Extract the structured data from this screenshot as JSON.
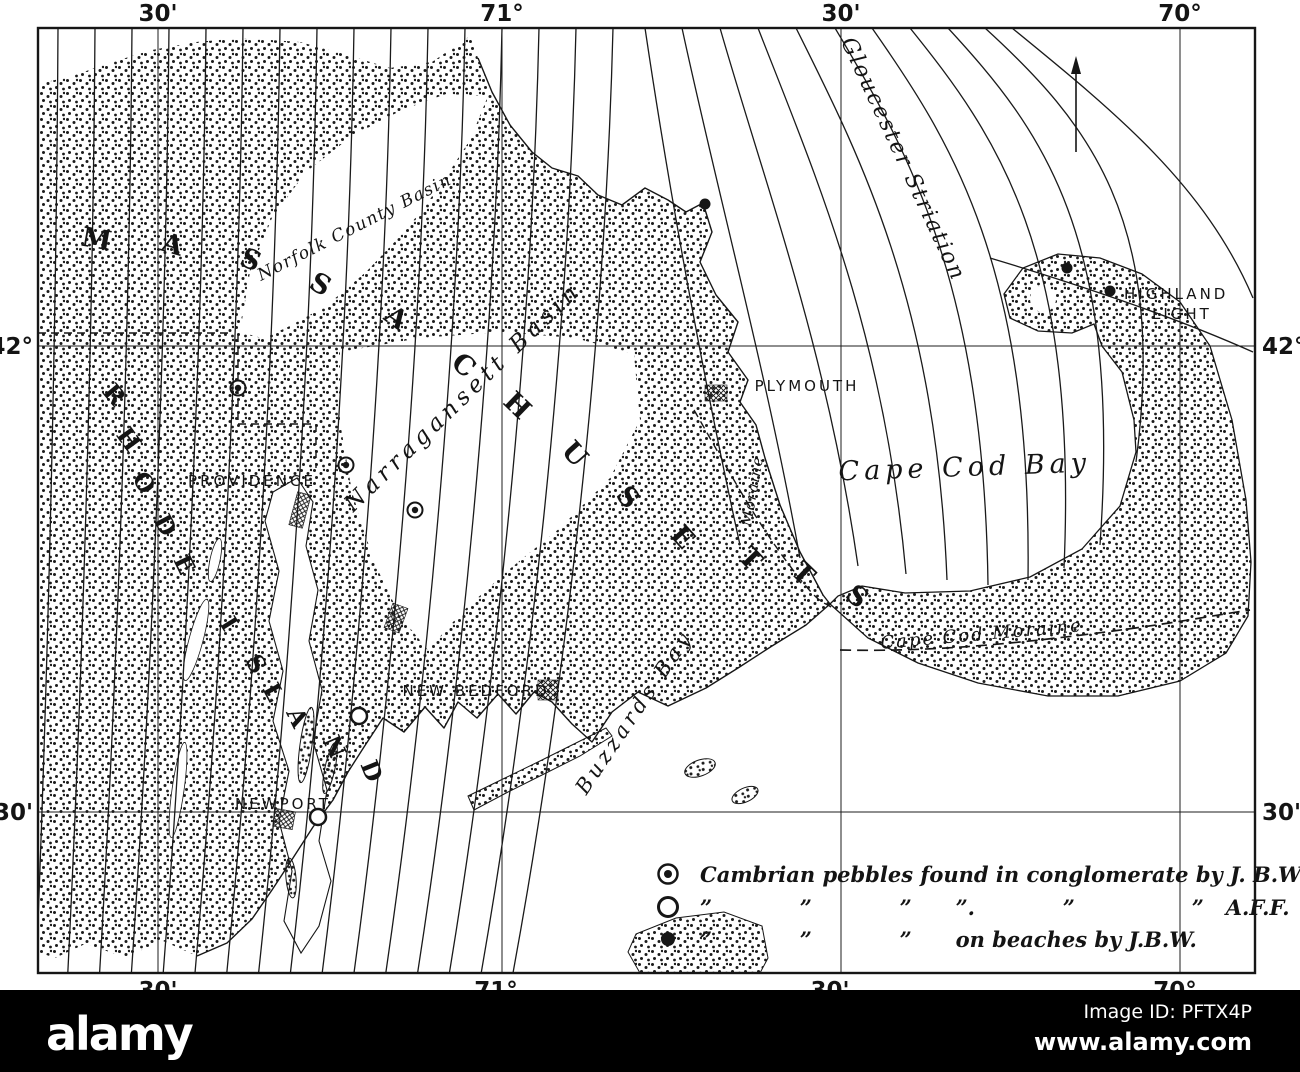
{
  "map": {
    "grid": {
      "top": [
        "30'",
        "71°",
        "30'",
        "70°"
      ],
      "bottom": [
        "30'",
        "71°",
        "30'",
        "70°"
      ],
      "left": [
        "42°",
        "30'"
      ],
      "right": [
        "42°",
        "30'"
      ]
    },
    "states": {
      "massachusetts": {
        "name": "MASSACHUSETTS",
        "letters": [
          "M",
          "A",
          "S",
          "S",
          "A",
          "C",
          "H",
          "U",
          "S",
          "E",
          "T",
          "T",
          "S"
        ]
      },
      "rhode_island": {
        "name": "RHODE ISLAND",
        "letters": [
          "R",
          "H",
          "O",
          "D",
          "E",
          "I",
          "S",
          "L",
          "A",
          "N",
          "D"
        ]
      }
    },
    "features": {
      "norfolk_county_basin": "Norfolk County Basin",
      "narragansett_basin": "Narragansett Basin",
      "gloucester_striation": "Gloucester Striation",
      "cape_cod_bay": "Cape Cod Bay",
      "cape_cod_moraine": "Cape Cod Moraine",
      "moraine": "Moraine",
      "buzzards_bay": "Buzzards Bay"
    },
    "places": {
      "providence": "PROVIDENCE",
      "plymouth": "PLYMOUTH",
      "new_bedford": "NEW BEDFORD",
      "newport": "NEWPORT",
      "highland_light_line1": "HIGHLAND",
      "highland_light_line2": "LIGHT"
    },
    "legend": {
      "row1": {
        "symbol": "circled-dot-icon",
        "text": "Cambrian pebbles found in conglomerate by J. B.W."
      },
      "row2": {
        "symbol": "open-circle-icon",
        "text": "”            ”            ”      ”.            ”                ”   A.F.F."
      },
      "row3": {
        "symbol": "filled-dot-icon",
        "text": "”            ”            ”      on beaches by J.B.W."
      }
    }
  },
  "watermark": {
    "logo_text": "alamy",
    "image_id_label": "Image ID: PFTX4P",
    "website": "www.alamy.com"
  },
  "colors": {
    "ink": "#161616",
    "paper": "#ffffff",
    "footer_bar": "#000000",
    "footer_text": "#ffffff"
  }
}
